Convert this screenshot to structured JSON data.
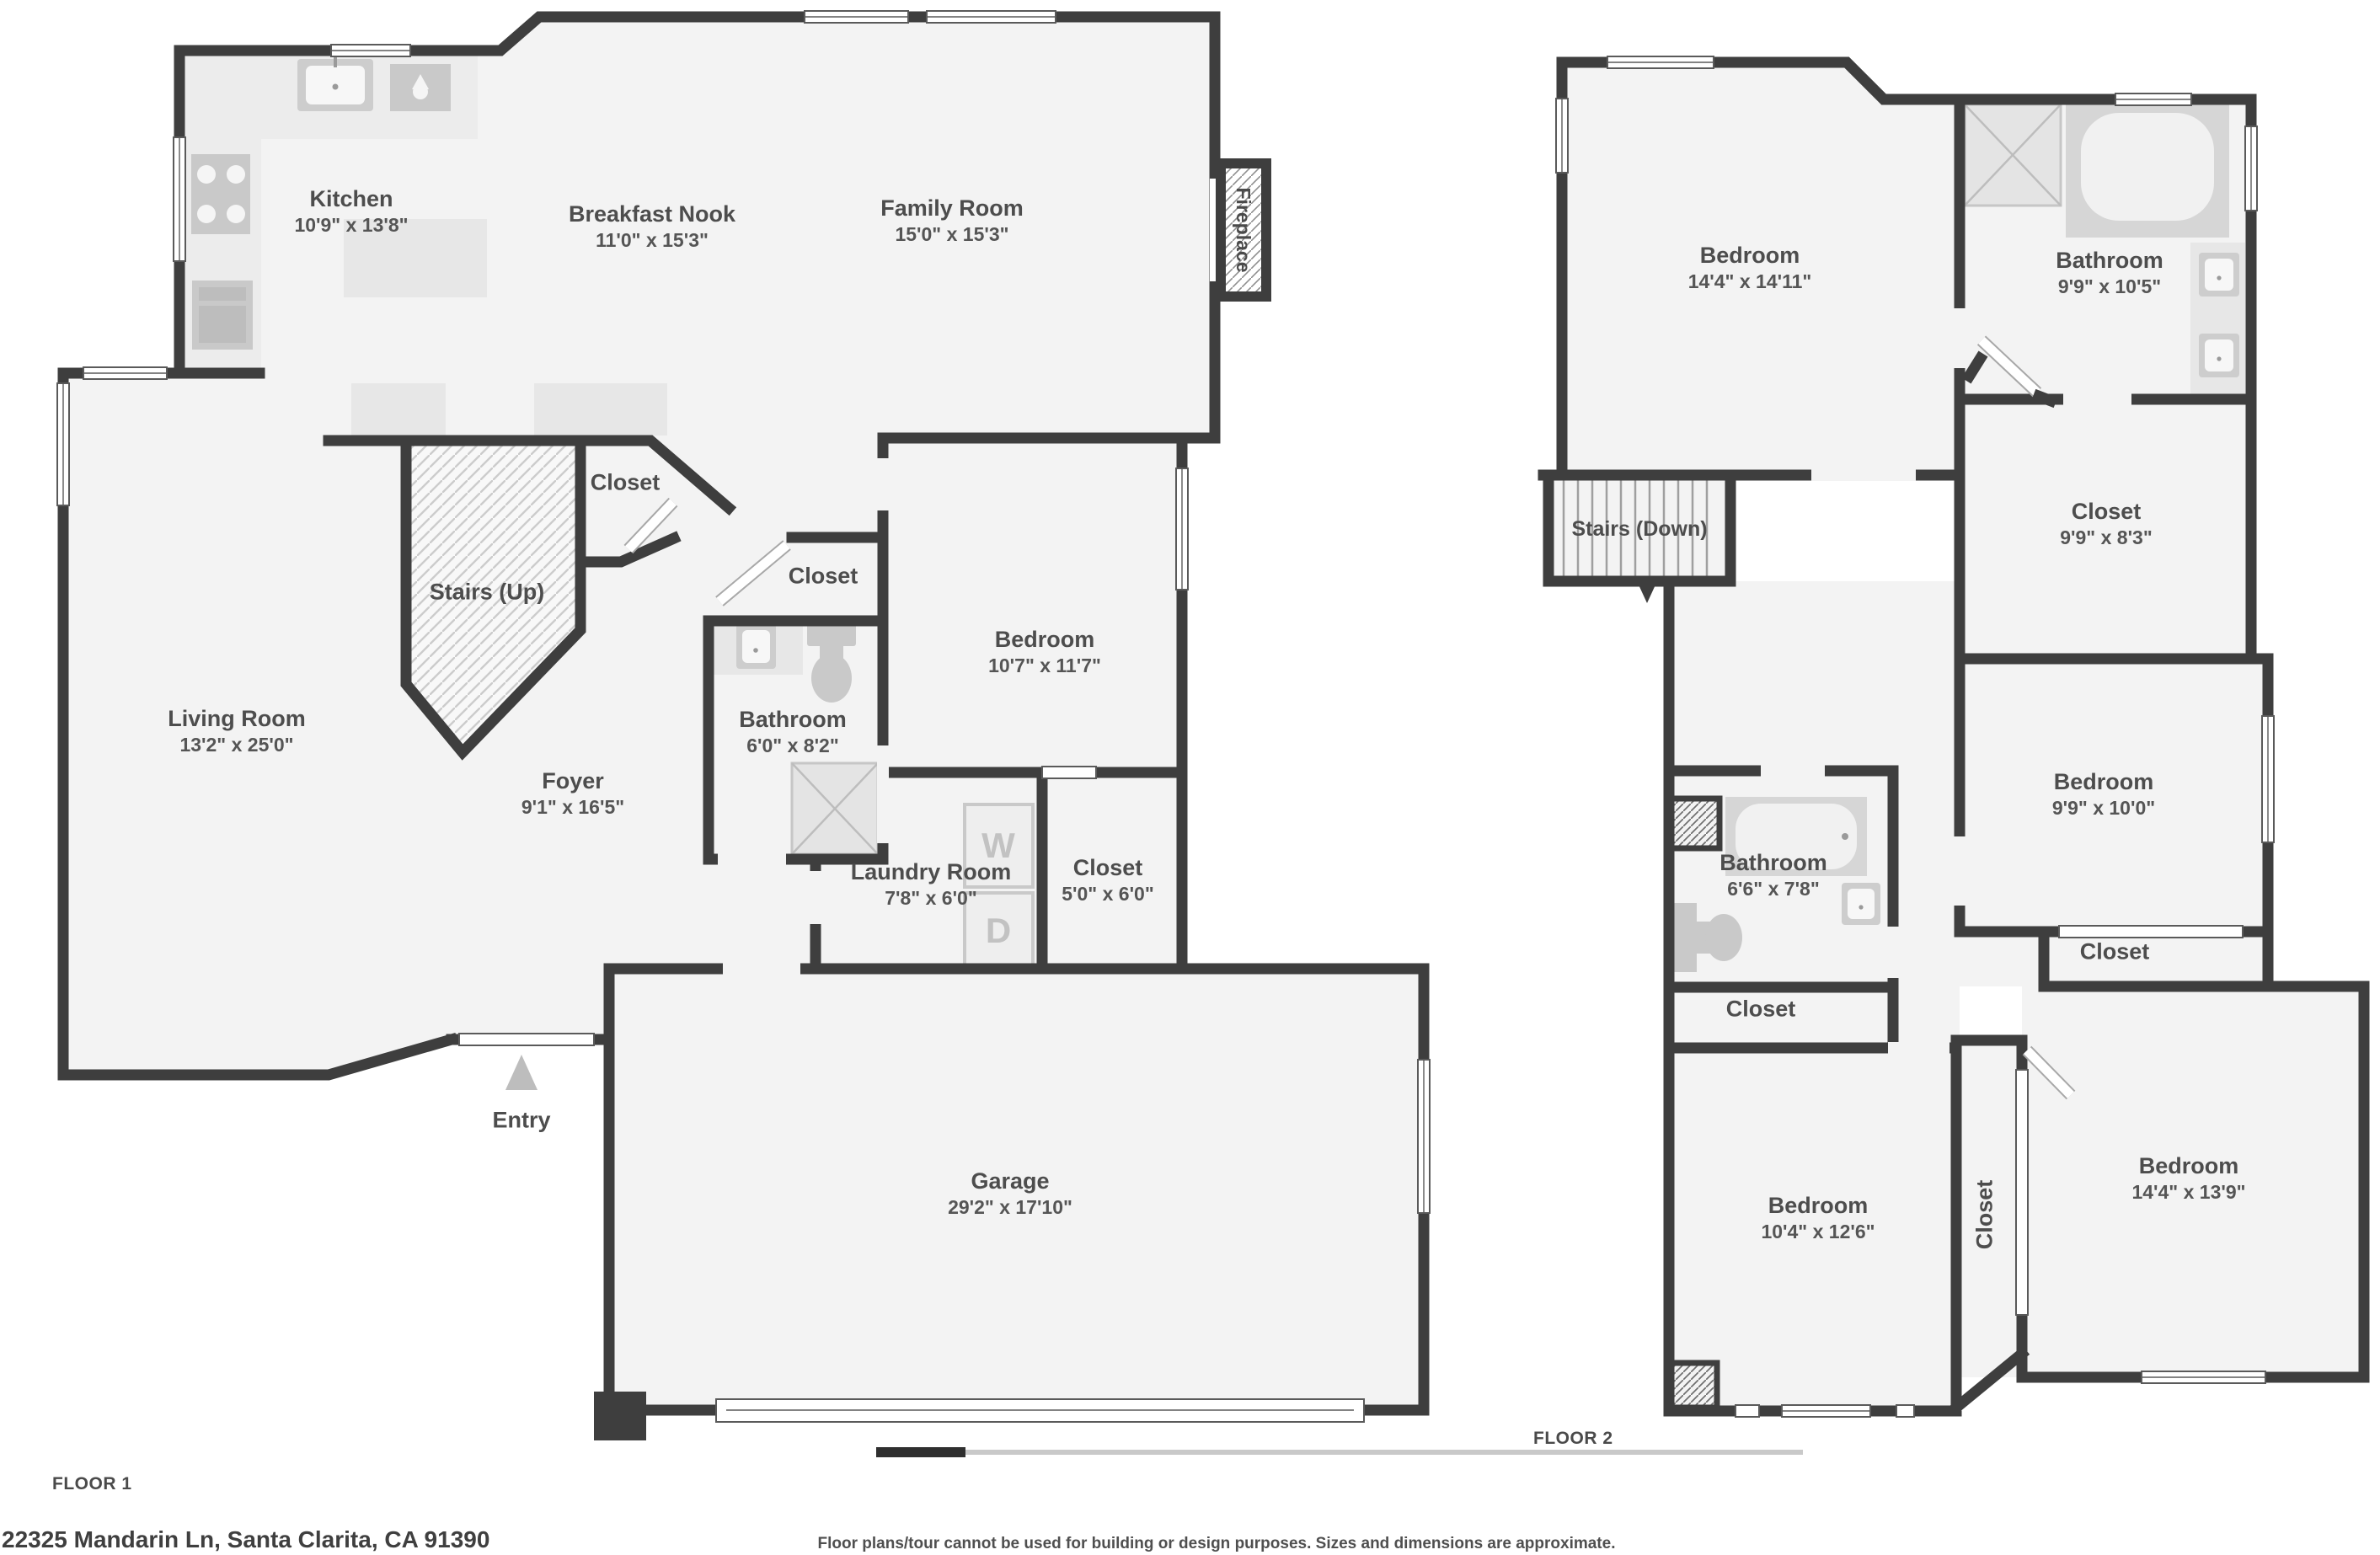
{
  "colors": {
    "wall": "#3e3e3e",
    "floor": "#f3f3f3",
    "fixture": "#cdcdcd",
    "counter": "#ececec",
    "text": "#4d4d4d"
  },
  "floor1": {
    "label": "FLOOR 1",
    "rooms": {
      "kitchen": {
        "name": "Kitchen",
        "dims": "10'9\" x 13'8\""
      },
      "breakfast_nook": {
        "name": "Breakfast Nook",
        "dims": "11'0\" x 15'3\""
      },
      "family_room": {
        "name": "Family Room",
        "dims": "15'0\" x 15'3\""
      },
      "living_room": {
        "name": "Living Room",
        "dims": "13'2\" x 25'0\""
      },
      "stairs": {
        "name": "Stairs (Up)"
      },
      "stairs_closet": {
        "name": "Closet"
      },
      "bath_closet": {
        "name": "Closet"
      },
      "bathroom": {
        "name": "Bathroom",
        "dims": "6'0\" x 8'2\""
      },
      "bedroom": {
        "name": "Bedroom",
        "dims": "10'7\" x 11'7\""
      },
      "foyer": {
        "name": "Foyer",
        "dims": "9'1\" x 16'5\""
      },
      "laundry": {
        "name": "Laundry Room",
        "dims": "7'8\" x 6'0\""
      },
      "closet": {
        "name": "Closet",
        "dims": "5'0\" x 6'0\""
      },
      "garage": {
        "name": "Garage",
        "dims": "29'2\" x 17'10\""
      },
      "entry": {
        "name": "Entry"
      },
      "fireplace": {
        "name": "Fireplace"
      },
      "washer": "W",
      "dryer": "D"
    }
  },
  "floor2": {
    "label": "FLOOR 2",
    "rooms": {
      "bedroom_main": {
        "name": "Bedroom",
        "dims": "14'4\" x 14'11\""
      },
      "bathroom_main": {
        "name": "Bathroom",
        "dims": "9'9\" x 10'5\""
      },
      "closet_main": {
        "name": "Closet",
        "dims": "9'9\" x 8'3\""
      },
      "stairs": {
        "name": "Stairs (Down)"
      },
      "bedroom_mid": {
        "name": "Bedroom",
        "dims": "9'9\" x 10'0\""
      },
      "bathroom2": {
        "name": "Bathroom",
        "dims": "6'6\" x 7'8\""
      },
      "closet2": {
        "name": "Closet"
      },
      "closet_right": {
        "name": "Closet"
      },
      "bedroom_left": {
        "name": "Bedroom",
        "dims": "10'4\" x 12'6\""
      },
      "closet_vertical": {
        "name": "Closet"
      },
      "bedroom_right": {
        "name": "Bedroom",
        "dims": "14'4\" x 13'9\""
      }
    }
  },
  "footer": {
    "address": "22325 Mandarin Ln, Santa Clarita, CA 91390",
    "disclaimer": "Floor plans/tour cannot be used for building or design purposes. Sizes and dimensions are approximate."
  }
}
